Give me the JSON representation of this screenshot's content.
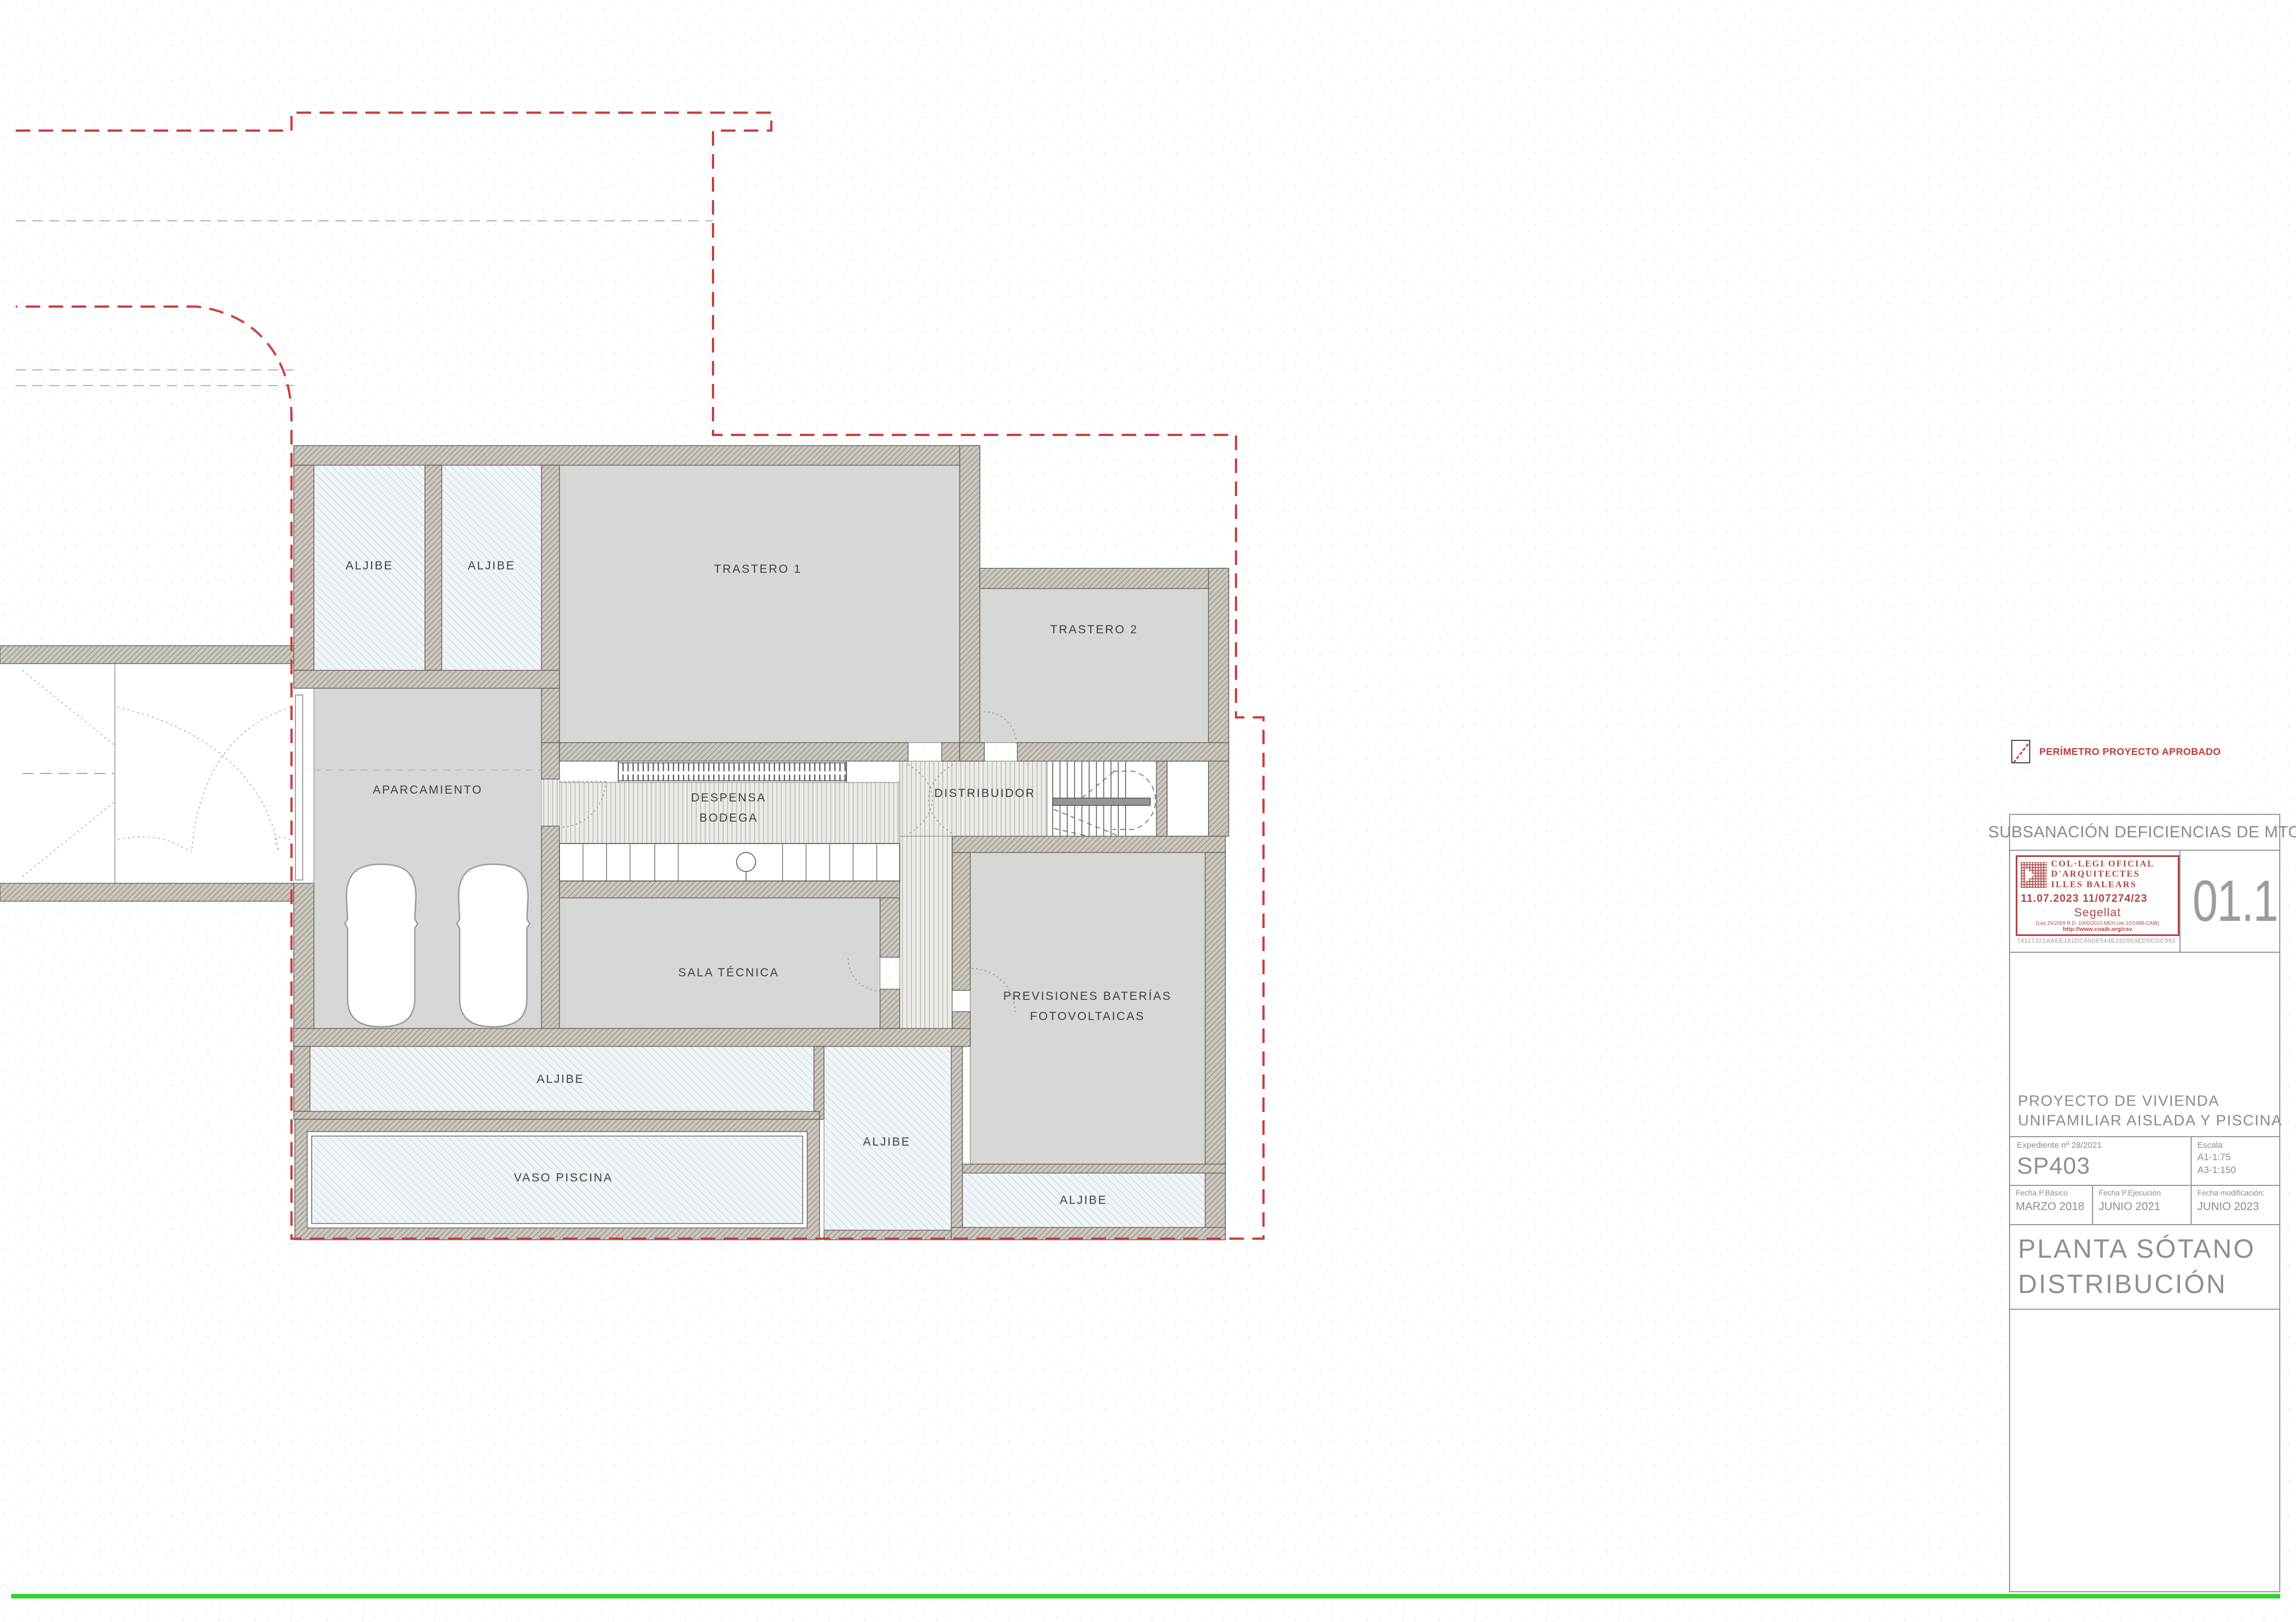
{
  "plan": {
    "rooms": [
      {
        "id": "aljibe-1",
        "label": "ALJIBE"
      },
      {
        "id": "aljibe-2",
        "label": "ALJIBE"
      },
      {
        "id": "trastero-1",
        "label": "TRASTERO 1"
      },
      {
        "id": "trastero-2",
        "label": "TRASTERO 2"
      },
      {
        "id": "aparcamiento",
        "label": "APARCAMIENTO"
      },
      {
        "id": "despensa-bodega",
        "label_line1": "DESPENSA",
        "label_line2": "BODEGA"
      },
      {
        "id": "distribuidor",
        "label": "DISTRIBUIDOR"
      },
      {
        "id": "sala-tecnica",
        "label": "SALA TÉCNICA"
      },
      {
        "id": "previsiones-baterias",
        "label_line1": "PREVISIONES BATERÍAS",
        "label_line2": "FOTOVOLTAICAS"
      },
      {
        "id": "aljibe-3",
        "label": "ALJIBE"
      },
      {
        "id": "aljibe-4",
        "label": "ALJIBE"
      },
      {
        "id": "vaso-piscina",
        "label": "VASO PISCINA"
      },
      {
        "id": "aljibe-5",
        "label": "ALJIBE"
      }
    ]
  },
  "legend": {
    "perimeter_label": "PERÍMETRO PROYECTO APROBADO"
  },
  "title_block": {
    "header": "SUBSANACIÓN DEFICIENCIAS DE MTO",
    "sheet_number": "01.1",
    "stamp": {
      "line1": "COL·LEGI  OFICIAL",
      "line2": "D'ARQUITECTES",
      "line3": "ILLES  BALEARS",
      "date_line": "11.07.2023    11/07274/23",
      "sealed_label": "Segellat",
      "law_line": "(Ley 25/2009  R.D. 1000/2010-MEH Llei 10/1998-CAIB)",
      "url_line": "http://www.coaib.org/csv",
      "hash": "74117321AAEE181DC650E543E192953ED5CDC992"
    },
    "project_title": {
      "line1": "PROYECTO DE VIVIENDA",
      "line2": "UNIFAMILIAR AISLADA Y PISCINA"
    },
    "expediente": "Expediente    nº 28/2021",
    "code": "SP403",
    "escala_label": "Escala:",
    "escala_a1": "A1-1:75",
    "escala_a3": "A3-1:150",
    "fechas": {
      "basico_label": "Fecha  P.Básico",
      "basico": "MARZO 2018",
      "ejecucion_label": "Fecha  P.Ejecución",
      "ejecucion": "JUNIO 2021",
      "modificacion_label": "Fecha  modificación:",
      "modificacion": "JUNIO 2023"
    },
    "drawing_title": {
      "line1": "PLANTA SÓTANO",
      "line2": "DISTRIBUCIÓN"
    }
  },
  "colors": {
    "perimeter_red": "#c94040",
    "approved_green": "#2fd42f",
    "wall_gray": "#8d887f",
    "room_gray": "#d7d7d5",
    "aljibe_blue": "#f0f5f8"
  }
}
